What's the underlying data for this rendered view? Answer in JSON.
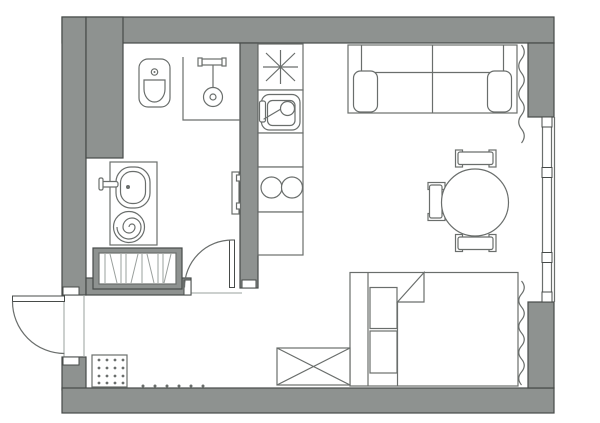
{
  "title": "studio-apartment-floor-plan",
  "colors": {
    "bg": "#ffffff",
    "wall": "#8e9290",
    "outline": "#474b49",
    "furniture": "#6a6e6c",
    "soft": "#9aa09d"
  },
  "rooms": [
    {
      "name": "bathroom",
      "fixtures": [
        "toilet",
        "shower-with-drain",
        "washbasin-on-counter",
        "washing-machine",
        "heated-towel-rail",
        "hatched-built-in-cabinet"
      ]
    },
    {
      "name": "kitchen",
      "fixtures": [
        "star-symbol-unit",
        "kitchen-sink-with-mixer",
        "two-burner-cooktop",
        "counter-run"
      ]
    },
    {
      "name": "living-sleeping-area",
      "fixtures": [
        "sofa",
        "round-dining-table",
        "chair",
        "chair",
        "chair",
        "bed-with-folded-blanket",
        "bedside-shelf-unit",
        "crossed-box-wardrobe"
      ]
    },
    {
      "name": "entry-hall",
      "fixtures": [
        "dotted-pouf",
        "floor-tick-dots"
      ]
    }
  ],
  "openings": {
    "entry_door": "left-wall, swings outward",
    "bathroom_door": "swings into bathroom",
    "window": "right-wall, tall 3-pane window with curtains top and bottom"
  },
  "counts": {
    "chairs": 3,
    "cooktop_burners": 2,
    "window_mullion_blocks": 4,
    "pouf_dot_grid": "4x4",
    "floor_dots": 6
  }
}
